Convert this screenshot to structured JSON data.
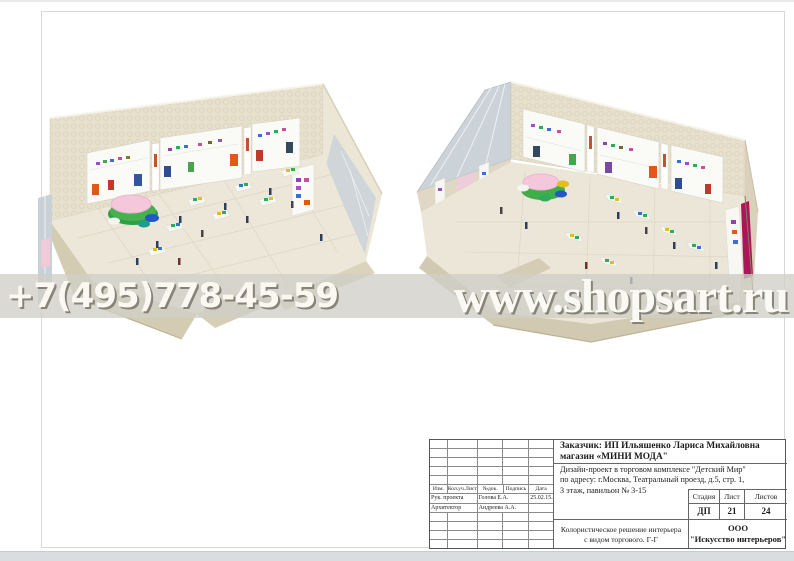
{
  "watermark": {
    "phone": "+7(495)778-45-59",
    "site": "www.shopsart.ru",
    "band_color": "#d0cec7",
    "text_color": "#faf8f1",
    "shadow_color": "#7d7a70"
  },
  "renders": {
    "left": {
      "alt": "store interior perspective view 1"
    },
    "right": {
      "alt": "store interior perspective view 2"
    },
    "palette": {
      "wall_cream": "#e7e0cc",
      "wall_outer": "#d4cbb3",
      "floor": "#ece7d8",
      "bay_white": "#fafaf7",
      "glass": "#cbd3d8",
      "table_top_pink": "#f5c7da",
      "table_base_green": "#2f9e44",
      "pouf_blue": "#2456c8",
      "accent_crimson": "#aa1658",
      "cloth_purple": "#9b51c0",
      "cloth_green": "#2eac5b",
      "cloth_blue": "#3a6fd8",
      "cloth_orange": "#e2581c",
      "cloth_magenta": "#c94f9e",
      "cloth_red": "#c0392b"
    }
  },
  "title_block": {
    "client_line1": "Заказчик:  ИП Ильяшенко Лариса Михайловна",
    "client_line2": "магазин «МИНИ МОДА\"",
    "project_line1": "Дизайн-проект в  торговом  комплексе \"Детский Мир\"",
    "project_line2": "по адресу: г.Москва, Театральный проезд, д.5, стр. 1,",
    "project_line3": "3 этаж, павильон № 3-15",
    "revision_headers": [
      "Изм.",
      "Кол.уч.Лист",
      "№док.",
      "Подпись",
      "Дата"
    ],
    "revision_rows": [
      {
        "role": "Рук. проекта",
        "name": "Голова Е.А.",
        "date": "25.02.15."
      },
      {
        "role": "Архитектор",
        "name": "Андреева А.А.",
        "date": ""
      }
    ],
    "stage_headers": [
      "Стадия",
      "Лист",
      "Листов"
    ],
    "stage_values": [
      "ДП",
      "21",
      "24"
    ],
    "sheet_title_line1": "Колористическое решение интерьера",
    "sheet_title_line2": "с видом торгового. Г-Г",
    "company_line1": "ООО",
    "company_line2": "\"Искусство интерьеров\""
  }
}
